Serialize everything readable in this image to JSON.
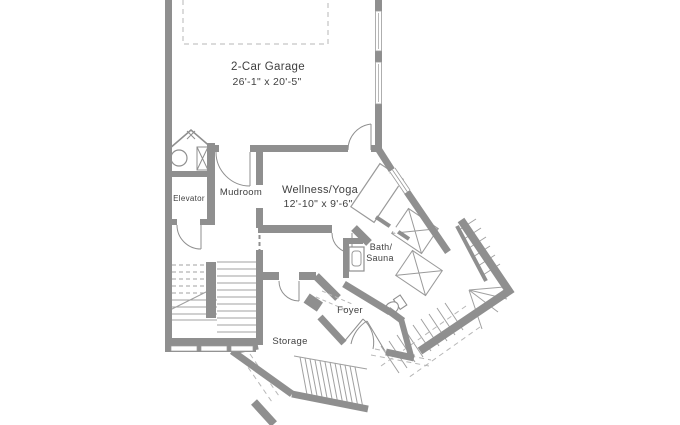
{
  "plan": {
    "type": "floor-plan",
    "rooms": {
      "garage": {
        "label": "2-Car Garage",
        "dims": "26'-1\" x 20'-5\""
      },
      "wellness": {
        "label": "Wellness/Yoga",
        "dims": "12'-10\" x 9'-6\""
      },
      "elevator": {
        "label": "Elevator"
      },
      "mudroom": {
        "label": "Mudroom"
      },
      "bath_sauna": {
        "line1": "Bath/",
        "line2": "Sauna"
      },
      "foyer": {
        "label": "Foyer"
      },
      "storage": {
        "label": "Storage"
      }
    },
    "features": [
      "parking-pad-dashed-outline",
      "garage-windows",
      "bifold-closet-doors",
      "utility-tank",
      "utility-chase",
      "elevator-door",
      "mudroom-door",
      "garage-entry-door",
      "u-stairs",
      "window-band",
      "yoga-mat",
      "sauna-benches",
      "vanity-sink",
      "toilet",
      "double-entry-doors",
      "exterior-l-stairs",
      "entry-porch-steps"
    ],
    "colors": {
      "wall": "#8f8f8f",
      "thin_line": "#a0a0a0",
      "dashed": "#b7b7b7",
      "text": "#3f3f3f",
      "background": "#ffffff"
    }
  }
}
